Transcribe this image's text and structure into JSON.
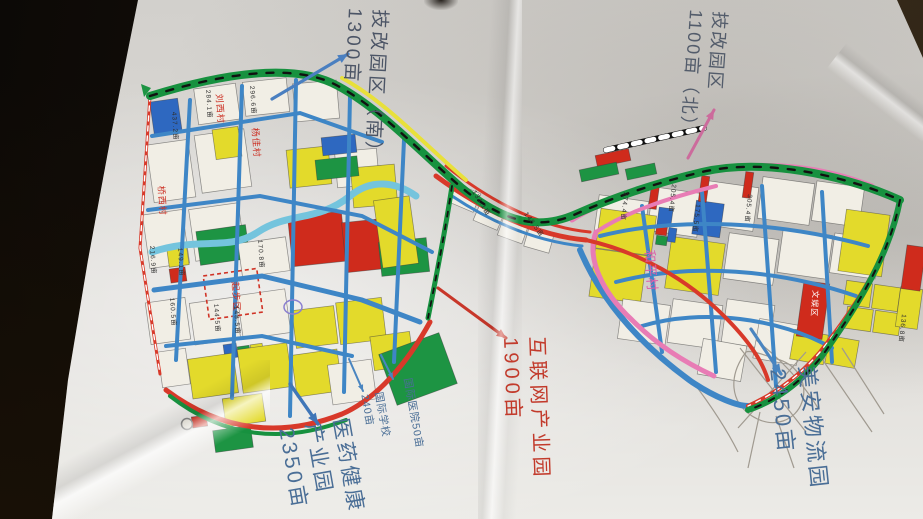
{
  "photo": {
    "table_color": "#15100a",
    "paper_color": "#d9d7d3"
  },
  "palette": {
    "Y": "#e3da2b",
    "W": "#f1eee5",
    "R": "#cf2b1c",
    "B": "#2e68c0",
    "G": "#1d9443",
    "P": "#e87cb5",
    "RD": "#d8392a",
    "BL": "#3e86c6",
    "HG": "#17913f",
    "WA": "#74c4dd",
    "YS": "#e8e03a",
    "RY": "#111111",
    "PEN": "#a09a90"
  },
  "annotations": [
    {
      "id": "tech-zone-south",
      "lines": [
        "技改园区（南）",
        "1300亩"
      ],
      "x": 392,
      "y": 10,
      "rot": 93,
      "size": 19,
      "ls": 3,
      "color": "#4c5566"
    },
    {
      "id": "tech-zone-north",
      "lines": [
        "技改园区",
        "1100亩（北）"
      ],
      "x": 731,
      "y": 12,
      "rot": 94,
      "size": 18,
      "ls": 2,
      "color": "#535c6b"
    },
    {
      "id": "internet-industry-park",
      "lines": [
        "互联网产业园",
        "1900亩"
      ],
      "x": 549,
      "y": 336,
      "rot": 88,
      "size": 20,
      "ls": 4,
      "color": "#c23a2b"
    },
    {
      "id": "meian-logistics-park",
      "lines": [
        "美安物流园",
        "2450亩"
      ],
      "x": 821,
      "y": 364,
      "rot": 84,
      "size": 22,
      "ls": 3,
      "color": "#4a6e96"
    },
    {
      "id": "pharma-health-park",
      "lines": [
        "医药健康",
        "产业园",
        "2350亩"
      ],
      "x": 353,
      "y": 416,
      "rot": 80,
      "size": 21,
      "ls": 3,
      "color": "#4a6e96"
    },
    {
      "id": "intl-hospital",
      "lines": [
        "国际医院50亩"
      ],
      "x": 413,
      "y": 377,
      "rot": 80,
      "size": 10.5,
      "ls": 1,
      "color": "#4a6e96"
    },
    {
      "id": "intl-school",
      "lines": [
        "国际学校",
        "240亩"
      ],
      "x": 384,
      "y": 391,
      "rot": 80,
      "size": 10.5,
      "ls": 1,
      "color": "#4a6e96"
    }
  ],
  "arrows": [
    {
      "id": "arrow-tech-south",
      "x1": 272,
      "y1": 99,
      "x2": 348,
      "y2": 54,
      "color": "#4a7fc0",
      "w": 3.2
    },
    {
      "id": "arrow-tech-north",
      "x1": 688,
      "y1": 158,
      "x2": 714,
      "y2": 110,
      "color": "#cc6b9c",
      "w": 3
    },
    {
      "id": "arrow-internet",
      "x1": 438,
      "y1": 288,
      "x2": 506,
      "y2": 338,
      "color": "#c8372a",
      "w": 3
    },
    {
      "id": "arrow-meian",
      "x1": 751,
      "y1": 329,
      "x2": 781,
      "y2": 374,
      "color": "#4a85c0",
      "w": 3.2
    },
    {
      "id": "arrow-pharma",
      "x1": 290,
      "y1": 384,
      "x2": 318,
      "y2": 424,
      "color": "#3f76b8",
      "w": 3.4
    },
    {
      "id": "arrow-hospital",
      "x1": 381,
      "y1": 355,
      "x2": 393,
      "y2": 379,
      "color": "#4a85c0",
      "w": 2
    },
    {
      "id": "arrow-school",
      "x1": 349,
      "y1": 359,
      "x2": 363,
      "y2": 391,
      "color": "#4a85c0",
      "w": 2
    }
  ],
  "map": {
    "parcels": [
      [
        152,
        100,
        28,
        34,
        -8,
        "B"
      ],
      [
        196,
        86,
        42,
        36,
        -8,
        "W"
      ],
      [
        244,
        80,
        44,
        34,
        -6,
        "W"
      ],
      [
        294,
        82,
        44,
        38,
        -5,
        "W"
      ],
      [
        150,
        142,
        42,
        58,
        -8,
        "W"
      ],
      [
        198,
        132,
        50,
        58,
        -8,
        "W"
      ],
      [
        214,
        128,
        26,
        30,
        -8,
        "Y"
      ],
      [
        288,
        148,
        42,
        38,
        -6,
        "Y"
      ],
      [
        336,
        150,
        42,
        36,
        -5,
        "W"
      ],
      [
        352,
        166,
        44,
        40,
        -5,
        "Y"
      ],
      [
        322,
        136,
        34,
        18,
        -6,
        "B"
      ],
      [
        316,
        158,
        42,
        20,
        -6,
        "G"
      ],
      [
        146,
        212,
        40,
        54,
        -8,
        "W"
      ],
      [
        192,
        206,
        50,
        52,
        -8,
        "W"
      ],
      [
        198,
        228,
        50,
        34,
        -8,
        "G"
      ],
      [
        168,
        248,
        20,
        18,
        -8,
        "Y"
      ],
      [
        170,
        268,
        16,
        14,
        -8,
        "R"
      ],
      [
        240,
        240,
        48,
        34,
        -8,
        "W"
      ],
      [
        290,
        214,
        54,
        50,
        -6,
        "R"
      ],
      [
        344,
        220,
        52,
        50,
        -6,
        "R"
      ],
      [
        380,
        240,
        48,
        34,
        -6,
        "G"
      ],
      [
        378,
        198,
        36,
        68,
        -8,
        "Y"
      ],
      [
        148,
        300,
        40,
        42,
        -8,
        "W"
      ],
      [
        192,
        300,
        46,
        42,
        -8,
        "W"
      ],
      [
        240,
        292,
        48,
        44,
        -8,
        "W"
      ],
      [
        294,
        308,
        42,
        38,
        -7,
        "Y"
      ],
      [
        338,
        300,
        46,
        42,
        -7,
        "Y"
      ],
      [
        224,
        344,
        13,
        14,
        -8,
        "B"
      ],
      [
        238,
        346,
        12,
        13,
        -8,
        "G"
      ],
      [
        251,
        344,
        12,
        13,
        -8,
        "Y"
      ],
      [
        160,
        350,
        28,
        36,
        -8,
        "W"
      ],
      [
        190,
        356,
        46,
        40,
        -8,
        "Y"
      ],
      [
        240,
        346,
        50,
        44,
        -8,
        "Y"
      ],
      [
        294,
        352,
        46,
        42,
        -8,
        "Y"
      ],
      [
        330,
        362,
        44,
        40,
        -8,
        "W"
      ],
      [
        372,
        334,
        40,
        34,
        -8,
        "Y"
      ],
      [
        214,
        428,
        38,
        22,
        -8,
        "G"
      ],
      [
        192,
        416,
        15,
        11,
        -8,
        "R"
      ],
      [
        224,
        396,
        40,
        28,
        -8,
        "Y"
      ],
      [
        386,
        342,
        64,
        54,
        -20,
        "G"
      ],
      [
        452,
        188,
        26,
        20,
        23,
        "W"
      ],
      [
        476,
        206,
        26,
        20,
        23,
        "W"
      ],
      [
        500,
        220,
        26,
        20,
        20,
        "W"
      ],
      [
        526,
        230,
        26,
        20,
        16,
        "W"
      ],
      [
        596,
        198,
        50,
        44,
        8,
        "W"
      ],
      [
        650,
        190,
        50,
        44,
        8,
        "W"
      ],
      [
        704,
        184,
        52,
        44,
        8,
        "W"
      ],
      [
        760,
        180,
        52,
        42,
        8,
        "W"
      ],
      [
        814,
        184,
        48,
        40,
        8,
        "W"
      ],
      [
        598,
        212,
        56,
        40,
        8,
        "Y"
      ],
      [
        592,
        252,
        52,
        48,
        8,
        "Y"
      ],
      [
        668,
        240,
        54,
        52,
        8,
        "Y"
      ],
      [
        694,
        202,
        28,
        34,
        8,
        "B"
      ],
      [
        658,
        208,
        14,
        18,
        8,
        "B"
      ],
      [
        656,
        226,
        11,
        9,
        8,
        "R"
      ],
      [
        656,
        236,
        11,
        9,
        8,
        "G"
      ],
      [
        668,
        228,
        8,
        14,
        8,
        "B"
      ],
      [
        726,
        236,
        50,
        46,
        8,
        "W"
      ],
      [
        780,
        232,
        50,
        44,
        8,
        "W"
      ],
      [
        832,
        236,
        46,
        40,
        8,
        "W"
      ],
      [
        620,
        302,
        48,
        40,
        8,
        "W"
      ],
      [
        670,
        302,
        50,
        44,
        8,
        "W"
      ],
      [
        724,
        302,
        48,
        44,
        8,
        "W"
      ],
      [
        756,
        322,
        44,
        40,
        10,
        "W"
      ],
      [
        700,
        342,
        44,
        36,
        10,
        "W"
      ],
      [
        842,
        212,
        44,
        62,
        8,
        "Y"
      ],
      [
        845,
        282,
        26,
        24,
        8,
        "Y"
      ],
      [
        873,
        286,
        26,
        24,
        8,
        "Y"
      ],
      [
        846,
        308,
        26,
        22,
        8,
        "Y"
      ],
      [
        874,
        312,
        26,
        22,
        8,
        "Y"
      ],
      [
        898,
        288,
        22,
        40,
        8,
        "Y"
      ],
      [
        792,
        332,
        34,
        30,
        10,
        "Y"
      ],
      [
        827,
        338,
        30,
        28,
        10,
        "Y"
      ],
      [
        800,
        282,
        26,
        56,
        8,
        "R"
      ],
      [
        904,
        246,
        19,
        44,
        8,
        "R"
      ],
      [
        650,
        183,
        8,
        26,
        8,
        "R"
      ],
      [
        700,
        176,
        8,
        26,
        8,
        "R"
      ],
      [
        744,
        172,
        8,
        26,
        8,
        "R"
      ],
      [
        596,
        152,
        34,
        12,
        -12,
        "R"
      ],
      [
        580,
        166,
        38,
        12,
        -12,
        "G"
      ],
      [
        626,
        166,
        30,
        11,
        -12,
        "G"
      ]
    ],
    "dashed_zone": {
      "x": 206,
      "y": 272,
      "w": 54,
      "h": 44,
      "rot": -8,
      "stroke": "#d03326"
    },
    "roads": [
      {
        "d": "M152,252 C200,236 228,252 258,232 C288,212 318,222 350,196 C372,178 396,182 416,196",
        "s": "WA",
        "w": 7
      },
      {
        "d": "M190,100 L176,360",
        "s": "BL",
        "w": 4
      },
      {
        "d": "M242,86 L232,398",
        "s": "BL",
        "w": 4
      },
      {
        "d": "M296,80 L290,416",
        "s": "BL",
        "w": 4
      },
      {
        "d": "M350,96 L344,392",
        "s": "BL",
        "w": 4
      },
      {
        "d": "M404,140 L394,362",
        "s": "BL",
        "w": 4
      },
      {
        "d": "M152,136 L300,113 L382,142",
        "s": "BL",
        "w": 4
      },
      {
        "d": "M148,210 L260,196 L362,216 L432,252",
        "s": "BL",
        "w": 4
      },
      {
        "d": "M154,290 L262,276 L362,300 L420,322",
        "s": "BL",
        "w": 5
      },
      {
        "d": "M166,346 L262,336 L352,356",
        "s": "BL",
        "w": 4
      },
      {
        "d": "M452,196 C500,228 544,242 582,246",
        "s": "BL",
        "w": 3
      },
      {
        "d": "M600,236 C680,216 780,222 868,246",
        "s": "BL",
        "w": 4
      },
      {
        "d": "M616,282 C692,262 780,270 856,296",
        "s": "BL",
        "w": 4
      },
      {
        "d": "M642,326 C702,308 780,318 832,348",
        "s": "BL",
        "w": 4
      },
      {
        "d": "M642,206 L662,352",
        "s": "BL",
        "w": 4
      },
      {
        "d": "M702,192 L716,372",
        "s": "BL",
        "w": 4
      },
      {
        "d": "M762,186 L776,386",
        "s": "BL",
        "w": 4
      },
      {
        "d": "M822,192 L832,362",
        "s": "BL",
        "w": 4
      },
      {
        "d": "M580,250 C602,302 642,346 692,382 C716,398 738,406 748,406",
        "s": "BL",
        "w": 6
      },
      {
        "d": "M572,220 C606,198 656,184 706,172 C766,158 826,168 872,186",
        "s": "P",
        "w": 5
      },
      {
        "d": "M596,232 C586,258 602,292 632,320 C658,346 688,364 714,376",
        "s": "P",
        "w": 5
      },
      {
        "d": "M596,232 C626,212 668,198 716,186",
        "s": "P",
        "w": 4
      },
      {
        "d": "M150,94 C232,70 300,66 336,84",
        "s": "#d96a6a",
        "w": 3
      },
      {
        "d": "M150,94 C232,70 300,66 336,84",
        "s": "#111111",
        "w": 2,
        "dash": "6 9"
      },
      {
        "d": "M150,96 L140,248 L160,374",
        "s": "RD",
        "w": 3
      },
      {
        "d": "M150,96 L140,248 L160,374",
        "s": "#ffffff",
        "w": 1.4,
        "dash": "5 5"
      },
      {
        "d": "M436,176 C488,214 540,236 586,240",
        "s": "RD",
        "w": 5
      },
      {
        "d": "M446,166 C496,206 546,228 590,232",
        "s": "RD",
        "w": 3
      },
      {
        "d": "M166,390 C222,432 282,438 342,414 C378,398 408,362 430,322",
        "s": "RD",
        "w": 5
      },
      {
        "d": "M170,396 C224,438 284,444 346,420",
        "s": "HG",
        "w": 4
      },
      {
        "d": "M586,240 C640,252 688,280 724,316 C748,340 762,360 768,380",
        "s": "RD",
        "w": 4
      },
      {
        "d": "M898,208 C886,258 858,304 820,352 C796,380 770,396 748,406",
        "s": "RD",
        "w": 4
      },
      {
        "d": "M898,208 C886,258 858,304 820,352 C796,380 770,396 748,406",
        "s": "#ffffff",
        "w": 1.4,
        "dash": "5 6"
      },
      {
        "d": "M342,78 C386,102 424,144 466,180",
        "s": "YS",
        "w": 4
      },
      {
        "d": "M150,96 C240,68 302,66 338,86 C382,110 420,152 462,188 C506,224 540,230 576,214 C612,198 652,184 702,172 C762,158 842,174 900,200",
        "s": "HG",
        "w": 8
      },
      {
        "d": "M150,96 C240,68 302,66 338,86 C382,110 420,152 462,188 C506,224 540,230 576,214 C612,198 652,184 702,172 C762,158 842,174 900,200",
        "s": "#111111",
        "w": 2.4,
        "dash": "7 10"
      },
      {
        "d": "M900,200 C890,252 862,300 822,356 C798,386 772,402 748,410",
        "s": "HG",
        "w": 6
      },
      {
        "d": "M900,200 C890,252 862,300 822,356 C798,386 772,402 748,410",
        "s": "#111111",
        "w": 2,
        "dash": "6 9"
      },
      {
        "d": "M452,186 C446,226 438,268 428,318",
        "s": "HG",
        "w": 5
      },
      {
        "d": "M452,186 C446,226 438,268 428,318",
        "s": "#111111",
        "w": 1.8,
        "dash": "5 8"
      },
      {
        "d": "M606,150 L704,128",
        "s": "RY",
        "w": 6
      },
      {
        "d": "M606,150 L704,128",
        "s": "#ffffff",
        "w": 5,
        "dash": "7 7"
      }
    ],
    "pencil": [
      "M746,352 C728,376 730,402 752,416 C774,430 796,420 802,402 C808,384 798,366 780,360 C762,354 750,350 746,352",
      "M740,348 L806,432",
      "M806,352 L738,428",
      "M756,340 C782,360 802,382 818,408",
      "M820,356 L872,432",
      "M842,348 L884,414",
      "M760,412 L748,468",
      "M776,416 L794,468",
      "M690,378 C710,404 726,428 738,452"
    ],
    "extras": {
      "roundabout": {
        "cx": 187,
        "cy": 424,
        "r": 5.5
      },
      "ring": {
        "cx": 293,
        "cy": 307,
        "rx": 9,
        "ry": 7
      },
      "north_mark": "M141,84 L151,88 L144,97 Z"
    },
    "labels": [
      {
        "t": "和平村",
        "x": 645,
        "y": 250,
        "rot": 86,
        "size": 13,
        "color": "#de5fa8"
      },
      {
        "t": "杨佳村",
        "x": 252,
        "y": 128,
        "rot": 86,
        "size": 9,
        "color": "#cc3024"
      },
      {
        "t": "桥西村",
        "x": 158,
        "y": 186,
        "rot": 86,
        "size": 9,
        "color": "#cc3024"
      },
      {
        "t": "刘西村",
        "x": 216,
        "y": 94,
        "rot": 86,
        "size": 9,
        "color": "#cc3024"
      },
      {
        "t": "起步区",
        "x": 232,
        "y": 282,
        "rot": 86,
        "size": 9,
        "color": "#d03326"
      },
      {
        "t": "文娱区",
        "x": 813,
        "y": 290,
        "rot": 94,
        "size": 8,
        "color": "#ffffff"
      },
      {
        "t": "284.1亩",
        "x": 206,
        "y": 90,
        "rot": 86,
        "size": 6.5,
        "color": "#2f2f2f"
      },
      {
        "t": "296.6亩",
        "x": 250,
        "y": 86,
        "rot": 86,
        "size": 6.5,
        "color": "#2f2f2f"
      },
      {
        "t": "437.2亩",
        "x": 172,
        "y": 112,
        "rot": 86,
        "size": 6.5,
        "color": "#2f2f2f"
      },
      {
        "t": "216.9亩",
        "x": 150,
        "y": 246,
        "rot": 86,
        "size": 6.5,
        "color": "#2f2f2f"
      },
      {
        "t": "149.1亩",
        "x": 178,
        "y": 248,
        "rot": 86,
        "size": 6.5,
        "color": "#2f2f2f"
      },
      {
        "t": "170.8亩",
        "x": 258,
        "y": 240,
        "rot": 86,
        "size": 6.5,
        "color": "#2f2f2f"
      },
      {
        "t": "160.5亩",
        "x": 170,
        "y": 298,
        "rot": 86,
        "size": 6.5,
        "color": "#2f2f2f"
      },
      {
        "t": "144.5亩",
        "x": 214,
        "y": 304,
        "rot": 86,
        "size": 6.5,
        "color": "#2f2f2f"
      },
      {
        "t": "148.5亩",
        "x": 234,
        "y": 306,
        "rot": 86,
        "size": 6.5,
        "color": "#2f2f2f"
      },
      {
        "t": "134.1亩",
        "x": 472,
        "y": 192,
        "rot": 58,
        "size": 6.5,
        "color": "#2f2f2f"
      },
      {
        "t": "148.5亩",
        "x": 524,
        "y": 214,
        "rot": 54,
        "size": 6.5,
        "color": "#2f2f2f"
      },
      {
        "t": "274.4亩",
        "x": 624,
        "y": 192,
        "rot": 96,
        "size": 6.5,
        "color": "#2f2f2f"
      },
      {
        "t": "205.4亩",
        "x": 672,
        "y": 184,
        "rot": 96,
        "size": 6.5,
        "color": "#2f2f2f"
      },
      {
        "t": "175.5亩",
        "x": 696,
        "y": 204,
        "rot": 96,
        "size": 6.5,
        "color": "#2f2f2f"
      },
      {
        "t": "305.4亩",
        "x": 748,
        "y": 194,
        "rot": 96,
        "size": 6.5,
        "color": "#2f2f2f"
      },
      {
        "t": "136.8亩",
        "x": 902,
        "y": 314,
        "rot": 96,
        "size": 6.5,
        "color": "#2f2f2f"
      }
    ]
  }
}
